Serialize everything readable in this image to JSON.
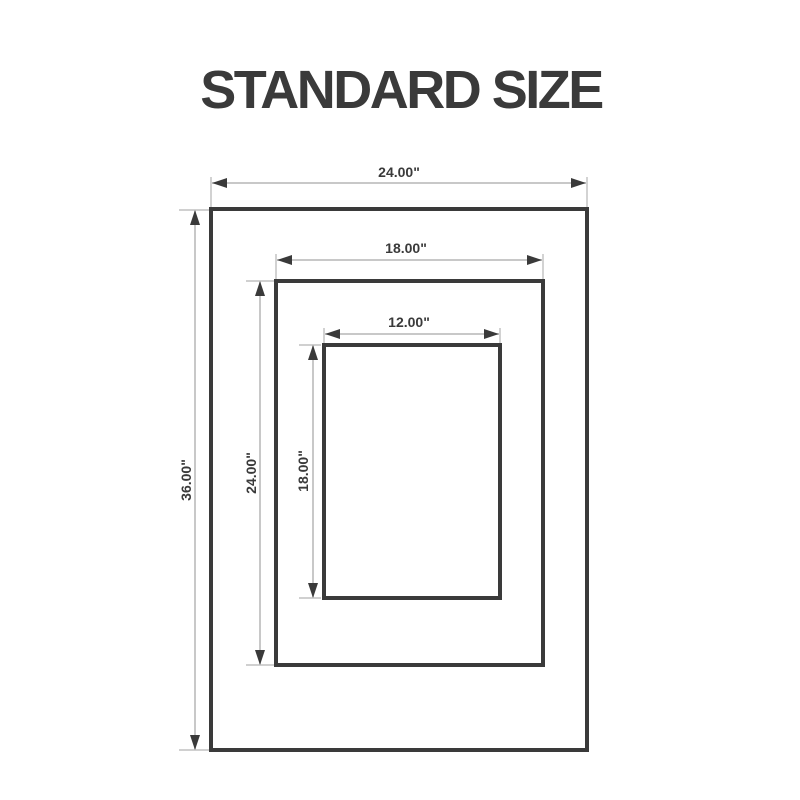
{
  "title": "STANDARD SIZE",
  "colors": {
    "outline": "#3a3a3a",
    "dim": "#b5b5b5",
    "label": "#3a3a3a",
    "background": "#ffffff"
  },
  "frames": [
    {
      "name": "outer frame",
      "width_label": "24.00\"",
      "height_label": "36.00\""
    },
    {
      "name": "middle frame",
      "width_label": "18.00\"",
      "height_label": "24.00\""
    },
    {
      "name": "inner frame",
      "width_label": "12.00\"",
      "height_label": "18.00\""
    }
  ]
}
